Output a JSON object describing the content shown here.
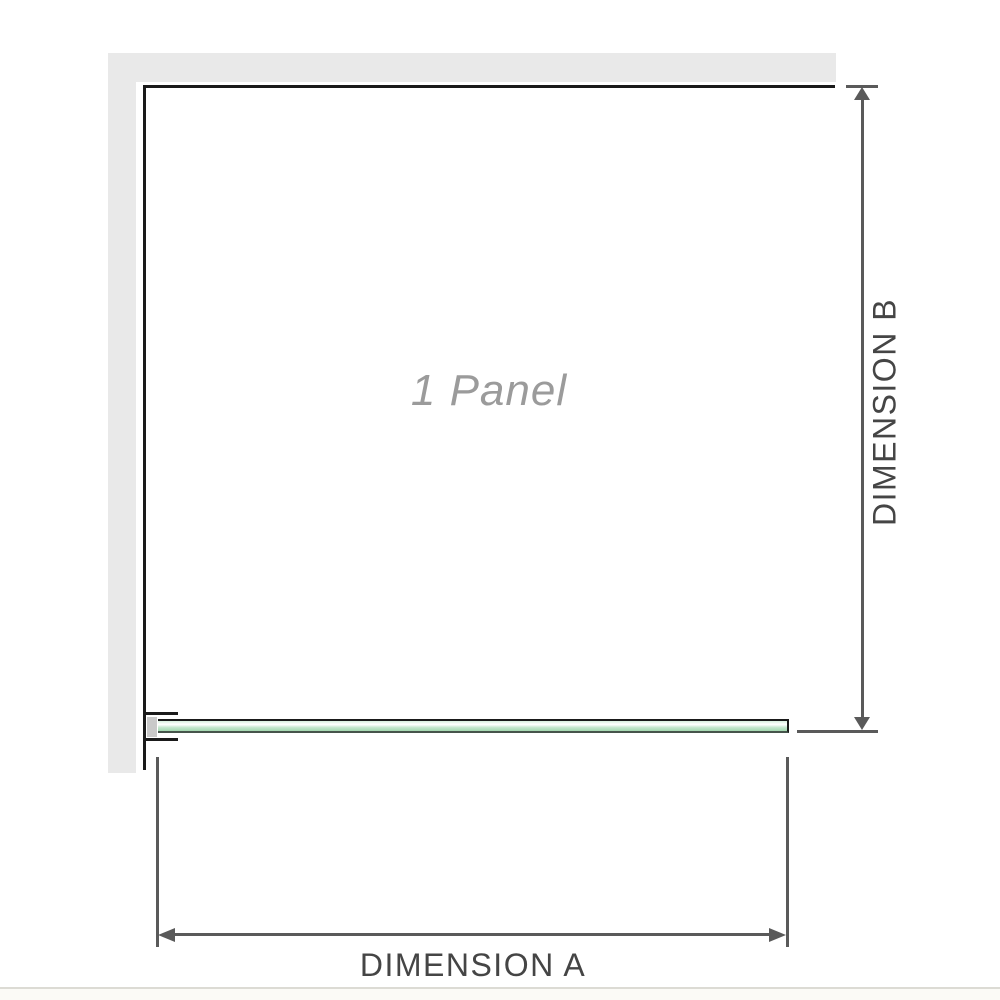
{
  "diagram": {
    "panel_label": "1 Panel",
    "dimensions": {
      "a_label": "DIMENSION A",
      "b_label": "DIMENSION B"
    }
  },
  "colors": {
    "wall_gray": "#e9e9e9",
    "outline_black": "#1a1a1a",
    "dimension_gray": "#5a5a5a",
    "label_gray": "#454545",
    "panel_text_gray": "#9b9b9b",
    "glass_green": "#a3d8b0",
    "glass_edge_green": "#46544b",
    "bracket_spacer_gray": "#c9c9c9",
    "divider_gray": "#dcdbd4"
  }
}
